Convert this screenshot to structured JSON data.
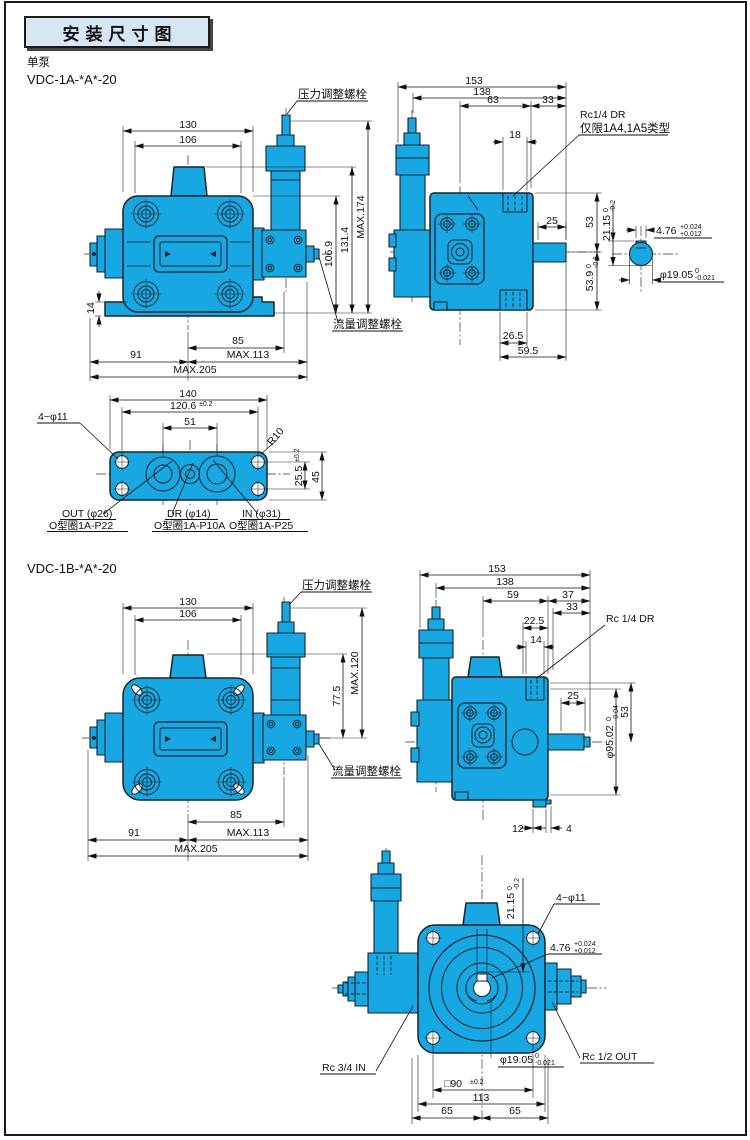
{
  "header": {
    "title": "安装尺寸图",
    "pump_kind": "单泵",
    "model_a": "VDC-1A-*A*-20",
    "model_b": "VDC-1B-*A*-20"
  },
  "labels": {
    "pressure_bolt": "压力调整螺栓",
    "flow_bolt": "流量调整螺栓",
    "rc14_dr": "Rc1/4 DR",
    "rc14_note": "仅限1A4,1A5类型",
    "rc14_dr_b": "Rc 1/4 DR",
    "rc34_in": "Rc 3/4 IN",
    "rc12_out": "Rc 1/2 OUT",
    "out_port": "OUT (φ26)",
    "out_oring": "O型圈1A-P22",
    "dr_port": "DR (φ14)",
    "dr_oring": "O型圈1A-P10A",
    "in_port": "IN (φ31)",
    "in_oring": "O型圈1A-P25",
    "four_holes": "4~φ11"
  },
  "dims": {
    "a_front": {
      "w130": "130",
      "w106": "106",
      "h_max": "MAX.174",
      "h131": "131.4",
      "h106": "106.9",
      "h14": "14",
      "b85": "85",
      "b113": "MAX.113",
      "b91": "91",
      "b205": "MAX.205"
    },
    "a_side": {
      "w153": "153",
      "w138": "138",
      "w63": "63",
      "w33": "33",
      "w18": "18",
      "s25": "25",
      "h53": "53",
      "h539": "53.9",
      "h539t": "0",
      "h539b": "-0.1",
      "b265": "26.5",
      "b595": "59.5"
    },
    "shaft": {
      "k2115": "21.15",
      "k2115t": "0",
      "k2115b": "-0.2",
      "k476": "4.76",
      "k476t": "+0.024",
      "k476b": "+0.012",
      "d1905": "φ19.05",
      "d1905t": "0",
      "d1905b": "-0.021"
    },
    "flange": {
      "w140": "140",
      "w1206": "120.6",
      "w1206tol": "±0.2",
      "w51": "51",
      "r10": "R10",
      "h255": "25.5",
      "h255tol": "±0.2",
      "h45": "45"
    },
    "b_front": {
      "w130": "130",
      "w106": "106",
      "h_max": "MAX.120",
      "h775": "77.5",
      "b85": "85",
      "b113": "MAX.113",
      "b91": "91",
      "b205": "MAX.205"
    },
    "b_side": {
      "w153": "153",
      "w138": "138",
      "w59": "59",
      "w37": "37",
      "w33": "33",
      "w225": "22.5",
      "w14": "14",
      "s25": "25",
      "h53": "53",
      "d95": "φ95.02",
      "d95t": "0",
      "d95b": "-0.04",
      "b12": "12",
      "b4": "4"
    },
    "b_bottom": {
      "k2115": "21.15",
      "k2115t": "0",
      "k2115b": "-0.2",
      "k476": "4.76",
      "k476t": "+0.024",
      "k476b": "+0.012",
      "d1905": "φ19.05",
      "d1905t": "0",
      "d1905b": "-0.021",
      "sq90": "□90",
      "sq90tol": "±0.2",
      "w113": "113",
      "w65l": "65",
      "w65r": "65"
    }
  },
  "colors": {
    "pump_fill": "#17a8e3",
    "line": "#15232e",
    "title_bg": "#d6e6f4"
  }
}
